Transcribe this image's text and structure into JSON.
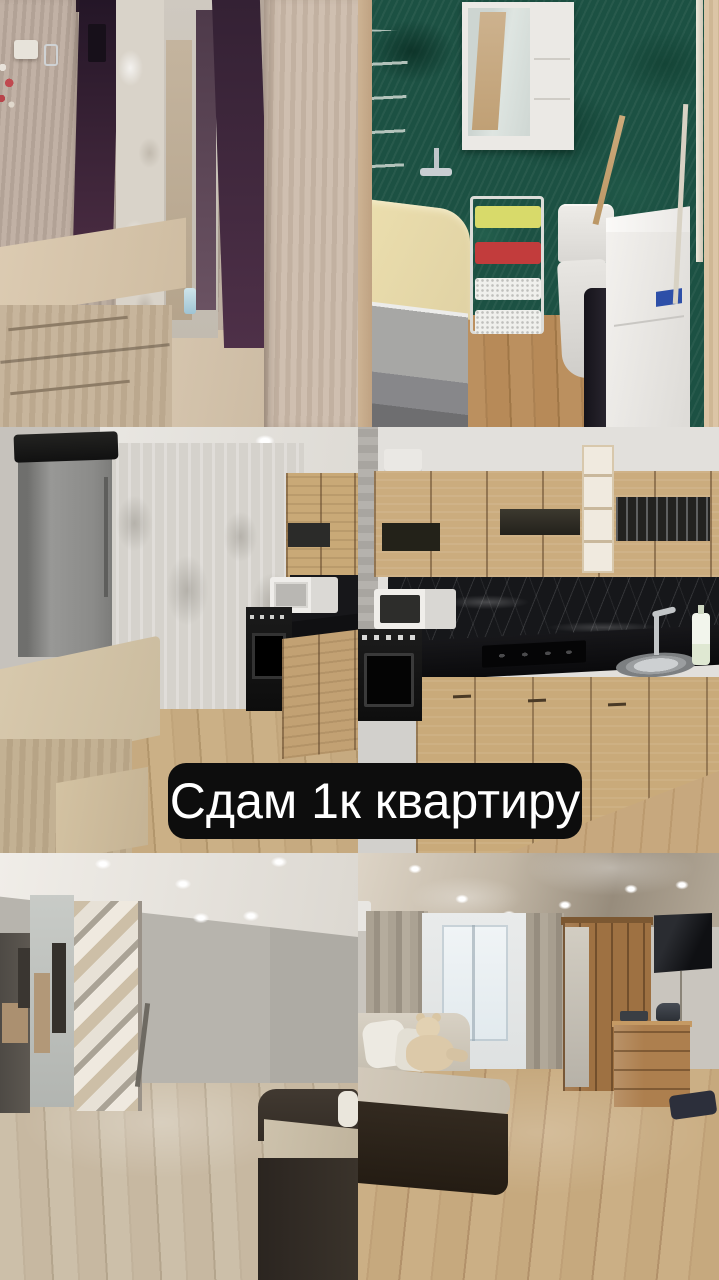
{
  "banner": {
    "text": "Сдам 1к квартиру",
    "background_color": "#0d0d0d",
    "text_color": "#ffffff"
  },
  "photos": [
    {
      "label": "hallway entry with purple wardrobe doors, tall mirror and shoe bench"
    },
    {
      "label": "bathroom with green wallpaper, bathtub, basket cart, toilet and washing machines"
    },
    {
      "label": "kitchen corner with grey fridge, sheer curtains, dining table, stool, oven and microwave"
    },
    {
      "label": "kitchen with oak cabinets, black marble backsplash, gas hob, sink and microwave"
    },
    {
      "label": "empty room with patterned wardrobe, mirror, hallway doorway and sofa corner"
    },
    {
      "label": "living room with sofa, teddy bear, window drapes, wardrobe, dresser, iron and wall TV"
    }
  ],
  "palette": {
    "banner_background": "#0d0d0d",
    "banner_text": "#ffffff",
    "bathroom_green": "#1c5143",
    "oak_cabinet": "#cbac7e",
    "wood_floor": "#c7a87e",
    "purple_wardrobe": "#3c2438"
  }
}
